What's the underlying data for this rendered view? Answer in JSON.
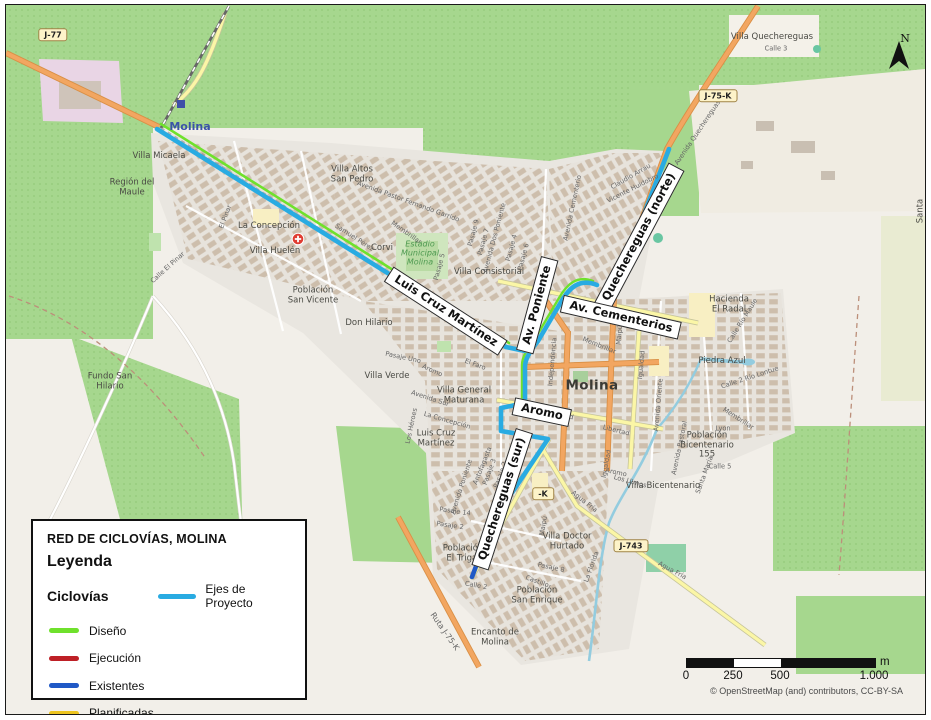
{
  "legend": {
    "title": "RED DE CICLOVÍAS, MOLINA",
    "heading": "Leyenda",
    "group": "Ciclovías",
    "project": {
      "label": "Ejes de Proyecto",
      "color": "#29ABE2"
    },
    "items": [
      {
        "label": "Diseño",
        "color": "#6FE12C"
      },
      {
        "label": "Ejecución",
        "color": "#BE2026"
      },
      {
        "label": "Existentes",
        "color": "#2059C6"
      },
      {
        "label": "Planificadas",
        "color": "#EDC41F"
      }
    ]
  },
  "scalebar": {
    "ticks": [
      "0",
      "250",
      "500",
      "1.000"
    ],
    "unit": "m"
  },
  "north_label": "N",
  "attribution": "© OpenStreetMap (and) contributors, CC-BY-SA",
  "colors": {
    "project_axis": "#29ABE2",
    "design": "#6FE12C",
    "execution": "#BE2026",
    "existing": "#2059C6",
    "planned": "#EDC41F",
    "field_green": "#A6D78E",
    "farmland": "#F2EFE9",
    "urban": "#E9E6E0",
    "primary_road": "#F2A661",
    "secondary_road": "#FBF6A6",
    "water": "#93CCDF"
  },
  "map": {
    "station_label": "Molina",
    "city_label": "Molina",
    "stadium_label": "Estadio\nMunicipal\nMolina",
    "sign_labels": [
      {
        "t": "Luis Cruz Martínez",
        "x": 440,
        "y": 306,
        "r": 33
      },
      {
        "t": "Av. Poniente",
        "x": 531,
        "y": 300,
        "r": -75
      },
      {
        "t": "Quechereguas (norte)",
        "x": 633,
        "y": 232,
        "r": -62
      },
      {
        "t": "Av. Cementerios",
        "x": 615,
        "y": 312,
        "r": 13
      },
      {
        "t": "Aromo",
        "x": 536,
        "y": 407,
        "r": 12
      },
      {
        "t": "Quechereguas (sur)",
        "x": 496,
        "y": 494,
        "r": -72
      }
    ],
    "shields": [
      {
        "t": "J-77",
        "x": 47,
        "y": 30,
        "r": 0
      },
      {
        "t": "J-75-K",
        "x": 712,
        "y": 91,
        "r": 0
      },
      {
        "t": "J-743",
        "x": 625,
        "y": 541,
        "r": 0
      },
      {
        "t": "-K",
        "x": 537,
        "y": 489,
        "r": 0
      }
    ],
    "area_labels": [
      {
        "t": "Villa Micaela",
        "x": 153,
        "y": 152
      },
      {
        "t": "Región del\nMaule",
        "x": 126,
        "y": 183
      },
      {
        "t": "La Concepción",
        "x": 263,
        "y": 222
      },
      {
        "t": "Villa Huelén",
        "x": 269,
        "y": 247
      },
      {
        "t": "Villa Altos\nSan Pedro",
        "x": 346,
        "y": 170
      },
      {
        "t": "Corvi",
        "x": 376,
        "y": 244
      },
      {
        "t": "Villa Consistorial",
        "x": 483,
        "y": 268
      },
      {
        "t": "Población\nSan Vicente",
        "x": 307,
        "y": 291
      },
      {
        "t": "Don Hilario",
        "x": 363,
        "y": 319
      },
      {
        "t": "Fundo San\nHilario",
        "x": 104,
        "y": 377
      },
      {
        "t": "Villa Verde",
        "x": 381,
        "y": 372
      },
      {
        "t": "Villa General\nMaturana",
        "x": 458,
        "y": 391
      },
      {
        "t": "Luis Cruz\nMartínez",
        "x": 430,
        "y": 434
      },
      {
        "t": "Hacienda\nEl Radal",
        "x": 723,
        "y": 300
      },
      {
        "t": "Piedra Azul",
        "x": 716,
        "y": 357
      },
      {
        "t": "Población\nBicentenario\n155",
        "x": 701,
        "y": 441
      },
      {
        "t": "Villa Bicentenario",
        "x": 657,
        "y": 482
      },
      {
        "t": "Villa Doctor\nHurtado",
        "x": 561,
        "y": 537
      },
      {
        "t": "Población\nEl Trigal",
        "x": 457,
        "y": 549
      },
      {
        "t": "Población\nSan Enrique",
        "x": 531,
        "y": 591
      },
      {
        "t": "Encanto de\nMolina",
        "x": 489,
        "y": 633
      },
      {
        "t": "Villa Quechereguas",
        "x": 766,
        "y": 33
      },
      {
        "t": "Santa Adela",
        "x": 920,
        "y": 206,
        "r": -90
      }
    ],
    "street_labels": [
      {
        "t": "Avenida Pastor Fernando Garrido",
        "x": 402,
        "y": 197,
        "r": 20
      },
      {
        "t": "Membrillar",
        "x": 400,
        "y": 228,
        "r": 35
      },
      {
        "t": "Samuel Pérez",
        "x": 348,
        "y": 233,
        "r": 33
      },
      {
        "t": "Avenida Dos Poniente",
        "x": 489,
        "y": 233,
        "r": -75
      },
      {
        "t": "Pasaje 9",
        "x": 468,
        "y": 228,
        "r": -75
      },
      {
        "t": "Pasaje 7",
        "x": 478,
        "y": 237,
        "r": -75
      },
      {
        "t": "Pasaje 4",
        "x": 506,
        "y": 243,
        "r": -75
      },
      {
        "t": "Pasaje 6",
        "x": 518,
        "y": 252,
        "r": -75
      },
      {
        "t": "Pasaje 5",
        "x": 434,
        "y": 262,
        "r": -75
      },
      {
        "t": "Avenida Cementerio",
        "x": 567,
        "y": 203,
        "r": -78
      },
      {
        "t": "Claudio Arrau",
        "x": 625,
        "y": 172,
        "r": -30
      },
      {
        "t": "Vicente Huidobro",
        "x": 627,
        "y": 184,
        "r": -27
      },
      {
        "t": "Avenida Quechereguas",
        "x": 692,
        "y": 128,
        "r": -56
      },
      {
        "t": "Membrillar",
        "x": 593,
        "y": 341,
        "r": 22
      },
      {
        "t": "Maipú",
        "x": 614,
        "y": 330,
        "r": -85
      },
      {
        "t": "Independencia",
        "x": 547,
        "y": 357,
        "r": -85
      },
      {
        "t": "Igualdad",
        "x": 636,
        "y": 360,
        "r": -85
      },
      {
        "t": "Libertad",
        "x": 554,
        "y": 410,
        "r": 14
      },
      {
        "t": "Libertad",
        "x": 610,
        "y": 426,
        "r": 14
      },
      {
        "t": "Igualdad",
        "x": 601,
        "y": 459,
        "r": -80
      },
      {
        "t": "Aromo",
        "x": 610,
        "y": 468,
        "r": 12
      },
      {
        "t": "Avenida Oriente",
        "x": 653,
        "y": 400,
        "r": -85
      },
      {
        "t": "Avenida Pastoral",
        "x": 674,
        "y": 443,
        "r": -78
      },
      {
        "t": "Agua Fría",
        "x": 578,
        "y": 497,
        "r": 38
      },
      {
        "t": "Agua Fría",
        "x": 666,
        "y": 566,
        "r": 28
      },
      {
        "t": "Los Ulmos",
        "x": 624,
        "y": 477,
        "r": 15
      },
      {
        "t": "Castillo",
        "x": 531,
        "y": 577,
        "r": 20
      },
      {
        "t": "Pasaje 8",
        "x": 545,
        "y": 563,
        "r": 12
      },
      {
        "t": "La Florida",
        "x": 586,
        "y": 562,
        "r": -70
      },
      {
        "t": "Maipú",
        "x": 538,
        "y": 521,
        "r": -80
      },
      {
        "t": "Avenida Sur",
        "x": 424,
        "y": 394,
        "r": 18
      },
      {
        "t": "La Concepción",
        "x": 441,
        "y": 416,
        "r": 16
      },
      {
        "t": "Los Héroes",
        "x": 406,
        "y": 421,
        "r": -78
      },
      {
        "t": "Antofagasta",
        "x": 477,
        "y": 461,
        "r": -68
      },
      {
        "t": "Avenida Poniente",
        "x": 456,
        "y": 482,
        "r": -72
      },
      {
        "t": "Pasaje 3",
        "x": 484,
        "y": 467,
        "r": -70
      },
      {
        "t": "Pasaje 2",
        "x": 495,
        "y": 470,
        "r": -70
      },
      {
        "t": "Pasaje 14",
        "x": 449,
        "y": 507,
        "r": 8
      },
      {
        "t": "Pasaje 2",
        "x": 444,
        "y": 521,
        "r": 8
      },
      {
        "t": "Calle 2",
        "x": 470,
        "y": 581,
        "r": 10
      },
      {
        "t": "El Faro",
        "x": 469,
        "y": 360,
        "r": 20
      },
      {
        "t": "Aromo",
        "x": 426,
        "y": 366,
        "r": 24
      },
      {
        "t": "Pasaje Uno",
        "x": 397,
        "y": 353,
        "r": 12
      },
      {
        "t": "Calle El Pinar",
        "x": 162,
        "y": 263,
        "r": -42
      },
      {
        "t": "El Pinar",
        "x": 220,
        "y": 212,
        "r": -70
      },
      {
        "t": "Calle Río Maule",
        "x": 737,
        "y": 316,
        "r": -58
      },
      {
        "t": "Calle 2 Río Lontue",
        "x": 744,
        "y": 373,
        "r": -18
      },
      {
        "t": "Membrillar",
        "x": 732,
        "y": 414,
        "r": 33
      },
      {
        "t": "Lyon",
        "x": 717,
        "y": 424,
        "r": 0
      },
      {
        "t": "Santa María",
        "x": 699,
        "y": 470,
        "r": -70
      },
      {
        "t": "Calle 5",
        "x": 714,
        "y": 462,
        "r": 0
      },
      {
        "t": "Calle 3",
        "x": 770,
        "y": 44,
        "r": 0
      },
      {
        "t": "Ruta J-75-K",
        "x": 438,
        "y": 627,
        "r": 55,
        "fs": 8
      }
    ]
  }
}
